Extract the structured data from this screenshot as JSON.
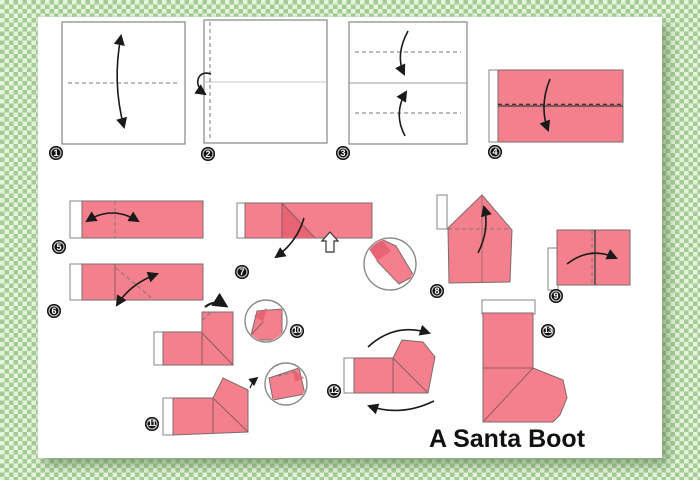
{
  "title": "A Santa Boot",
  "steps": [
    {
      "num": "1"
    },
    {
      "num": "2"
    },
    {
      "num": "3"
    },
    {
      "num": "4"
    },
    {
      "num": "5"
    },
    {
      "num": "6"
    },
    {
      "num": "7"
    },
    {
      "num": "8"
    },
    {
      "num": "9"
    },
    {
      "num": "10"
    },
    {
      "num": "11"
    },
    {
      "num": "12"
    },
    {
      "num": "13"
    }
  ],
  "colors": {
    "paper_pink": "#f4808d",
    "paper_pink_dark": "#e86374",
    "bg_green": "#a3cd92",
    "bg_green_light": "#e7f1df",
    "badge_black": "#111111",
    "title_color": "#111111",
    "outline_gray": "#858585",
    "arrow_black": "#1a1a1a"
  }
}
